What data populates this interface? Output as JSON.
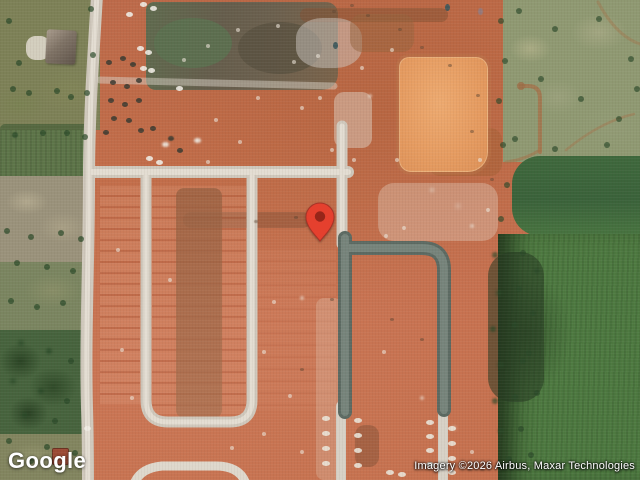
{
  "map": {
    "provider_logo": "Google",
    "attribution": "Imagery ©2026 Airbus, Maxar Technologies",
    "view": "satellite",
    "pin": {
      "color": "#E5402E",
      "inner_color": "#962519",
      "outline_color": "#A93226"
    },
    "palette": {
      "dirt": "#C26C48",
      "dirt_light": "#D2886A",
      "graded_pad": "#E59B60",
      "road_light": "#D6D0C5",
      "road_dark": "#66756C",
      "field_olive": "#7D8157",
      "field_sage": "#8F9972",
      "field_dark_green": "#3E683C",
      "field_green": "#4E7A41",
      "forest": "#46633D"
    }
  }
}
